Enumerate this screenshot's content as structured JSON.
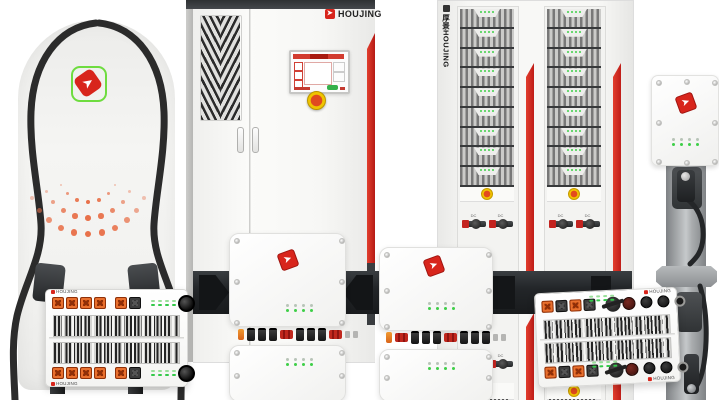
{
  "brand": {
    "name": "HOUJING",
    "cabinet_logo_text": "HOUJING",
    "rack_side_text": "厚景HOUJING",
    "module_logo_text": "HOUJING"
  },
  "icons": {
    "logo_arrow": "➤"
  },
  "colors": {
    "logo_red": "#d8251c",
    "logo_green_ring": "#6edc3f",
    "accent_red_stripe": "#c9201d",
    "connector_orange": "#dd5b16",
    "led_green": "#3ecf48",
    "estop_yellow": "#efc400",
    "estop_red": "#e04a20",
    "cable_black": "#2b2b2b",
    "band_dark": "#232629",
    "pillar_gray": "#a9acae",
    "dot_orange": "#e8714a"
  },
  "dc_pillar": {
    "dot_arcs": [
      {
        "r": 30,
        "n": 7
      },
      {
        "r": 46,
        "n": 9
      },
      {
        "r": 62,
        "n": 11
      }
    ]
  },
  "rack": {
    "columns": 2,
    "modules_per_column": 9,
    "leds_per_module": 4,
    "switches_per_column": 2,
    "switch_label": "DC"
  },
  "power_modules": {
    "led_groups": 4,
    "left": {
      "top_connectors": [
        "orange",
        "orange",
        "orange",
        "orange",
        "gap",
        "orange",
        "black"
      ]
    },
    "right": {
      "top_connectors": [
        "orange",
        "black",
        "orange",
        "black"
      ],
      "round_connectors": [
        "maroon",
        "black",
        "black",
        "ring"
      ]
    }
  },
  "wall_chargers": {
    "led_rows": 2,
    "leds_per_row": 4,
    "unit1_ports": [
      "orange",
      "black",
      "black",
      "black",
      "red",
      "black",
      "black",
      "black",
      "red",
      "grey",
      "grey"
    ],
    "unit2_ports": [
      "orange",
      "red",
      "black",
      "black",
      "black",
      "red",
      "black",
      "black",
      "black",
      "grey",
      "grey"
    ]
  }
}
